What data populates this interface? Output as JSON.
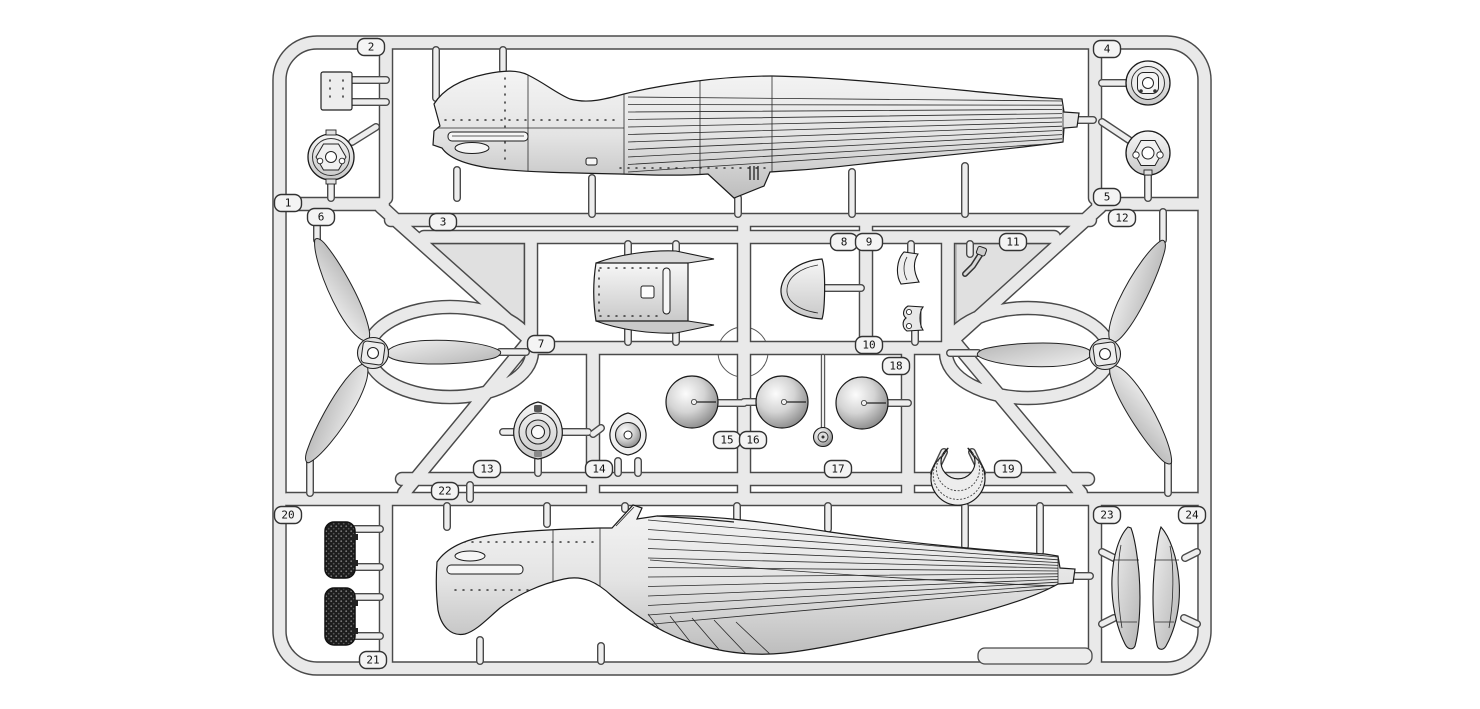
{
  "diagram": {
    "kind": "plastic model kit sprue parts-layout illustration",
    "background": "#ffffff",
    "plastic_color": "#e9e9e9",
    "outline_color": "#4a4a4a",
    "web_color": "#e0e0e0",
    "grille_color": "#1c1c1c"
  },
  "tags": [
    {
      "label": "1"
    },
    {
      "label": "2"
    },
    {
      "label": "3"
    },
    {
      "label": "4"
    },
    {
      "label": "5"
    },
    {
      "label": "6"
    },
    {
      "label": "7"
    },
    {
      "label": "8"
    },
    {
      "label": "9"
    },
    {
      "label": "10"
    },
    {
      "label": "11"
    },
    {
      "label": "12"
    },
    {
      "label": "13"
    },
    {
      "label": "14"
    },
    {
      "label": "15"
    },
    {
      "label": "16"
    },
    {
      "label": "17"
    },
    {
      "label": "18"
    },
    {
      "label": "19"
    },
    {
      "label": "20"
    },
    {
      "label": "21"
    },
    {
      "label": "22"
    },
    {
      "label": "23"
    },
    {
      "label": "24"
    }
  ],
  "parts": [
    {
      "tag": "1",
      "shape": "cowl-ring"
    },
    {
      "tag": "2",
      "shape": "access-panel"
    },
    {
      "tag": "3",
      "shape": "fuselage-half-upper"
    },
    {
      "tag": "4",
      "shape": "engine-front-disc"
    },
    {
      "tag": "5",
      "shape": "firewall-disc"
    },
    {
      "tag": "6",
      "shape": "three-blade-propeller"
    },
    {
      "tag": "7",
      "shape": "cowling-panel"
    },
    {
      "tag": "8",
      "shape": "cowl-flap-half-ring"
    },
    {
      "tag": "9",
      "shape": "bracket"
    },
    {
      "tag": "10",
      "shape": "clamp-yoke"
    },
    {
      "tag": "11",
      "shape": "control-lever"
    },
    {
      "tag": "12",
      "shape": "three-blade-propeller"
    },
    {
      "tag": "13",
      "shape": "reduction-gear-housing"
    },
    {
      "tag": "14",
      "shape": "hub-housing"
    },
    {
      "tag": "15",
      "shape": "spinner-dome"
    },
    {
      "tag": "16",
      "shape": "spinner-dome"
    },
    {
      "tag": "17",
      "shape": "hub-cap"
    },
    {
      "tag": "18",
      "shape": "spinner-dome"
    },
    {
      "tag": "19",
      "shape": "exhaust-collector-ring"
    },
    {
      "tag": "20",
      "shape": "radiator-grille"
    },
    {
      "tag": "21",
      "shape": "radiator-grille"
    },
    {
      "tag": "22",
      "shape": "fuselage-half-lower"
    },
    {
      "tag": "23",
      "shape": "exhaust-fairing"
    },
    {
      "tag": "24",
      "shape": "exhaust-fairing"
    }
  ]
}
